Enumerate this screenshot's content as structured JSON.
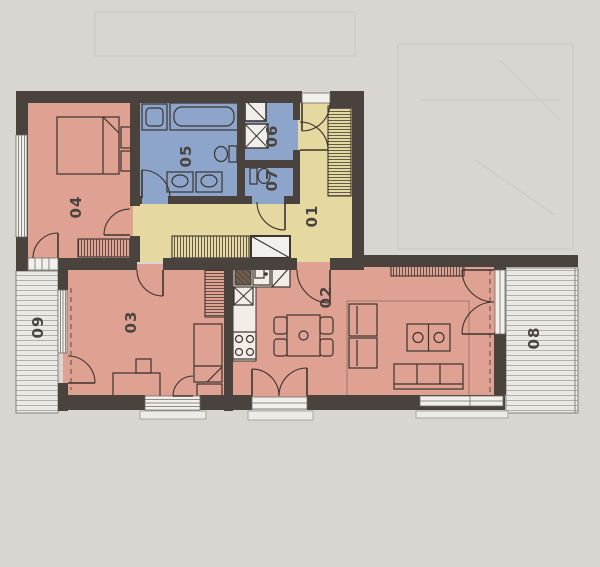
{
  "floorplan": {
    "rooms": [
      {
        "label": "01"
      },
      {
        "label": "02"
      },
      {
        "label": "03"
      },
      {
        "label": "04"
      },
      {
        "label": "05"
      },
      {
        "label": "06"
      },
      {
        "label": "07"
      },
      {
        "label": "08"
      },
      {
        "label": "09"
      }
    ],
    "colors": {
      "background": "#d9d6d1",
      "wall": "#49423d",
      "pink": "#dfa192",
      "blue": "#8da5cb",
      "yellow": "#e6d8a1",
      "balcony_fill": "#ebe9e5",
      "balcony_line": "#b2b0ab",
      "label": "#4a443e",
      "furniture_line": "#3b342f"
    }
  }
}
